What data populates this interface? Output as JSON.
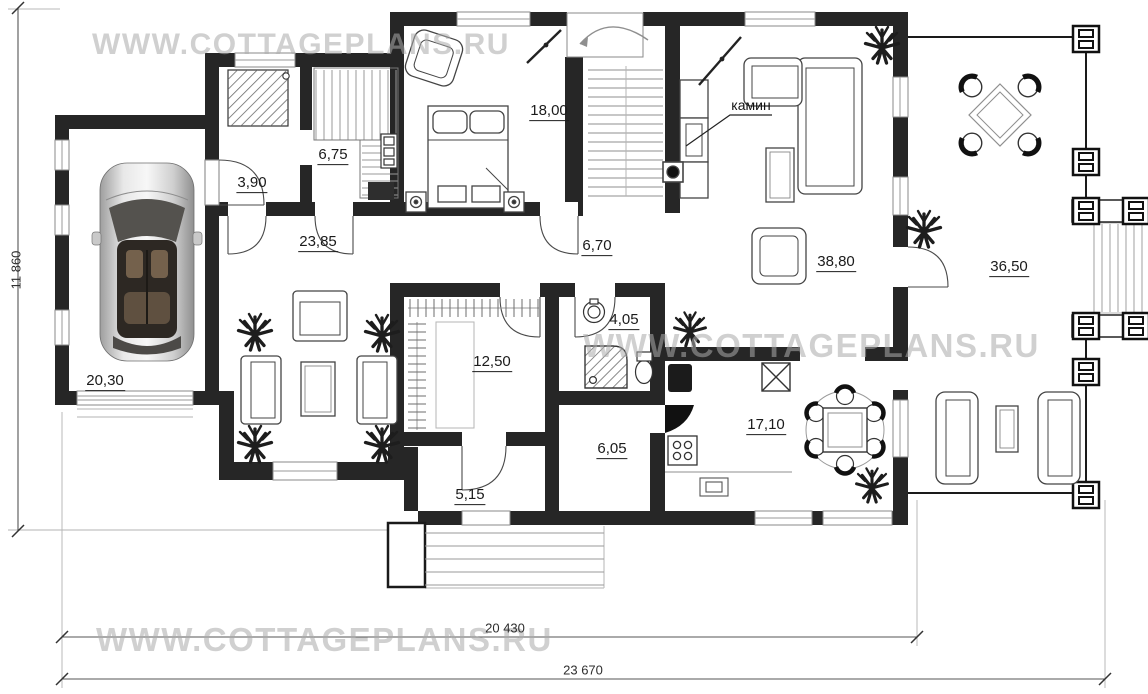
{
  "watermarks": {
    "top": "WWW.COTTAGEPLANS.RU",
    "middle": "WWW.COTTAGEPLANS.RU",
    "bottom": "WWW.COTTAGEPLANS.RU"
  },
  "rooms": [
    {
      "name": "shower-room",
      "area": "3,90"
    },
    {
      "name": "sauna",
      "area": "6,75"
    },
    {
      "name": "bedroom",
      "area": "18,00"
    },
    {
      "name": "hall",
      "area": "23,85"
    },
    {
      "name": "corridor",
      "area": "6,70"
    },
    {
      "name": "living-room",
      "area": "38,80"
    },
    {
      "name": "terrace",
      "area": "36,50"
    },
    {
      "name": "garage",
      "area": "20,30"
    },
    {
      "name": "wardrobe",
      "area": "12,50"
    },
    {
      "name": "bathroom",
      "area": "4,05"
    },
    {
      "name": "utility",
      "area": "6,05"
    },
    {
      "name": "kitchen-dining",
      "area": "17,10"
    },
    {
      "name": "entry",
      "area": "5,15"
    }
  ],
  "annotations": {
    "fireplace": "камин"
  },
  "dimensions": {
    "left_height": "11 860",
    "bottom_inner": "20 430",
    "bottom_outer": "23 670"
  },
  "colors": {
    "wall": "#262626",
    "line_dark": "#333333",
    "line_light": "#9a9a9a",
    "watermark": "#ababab",
    "background": "#ffffff"
  }
}
